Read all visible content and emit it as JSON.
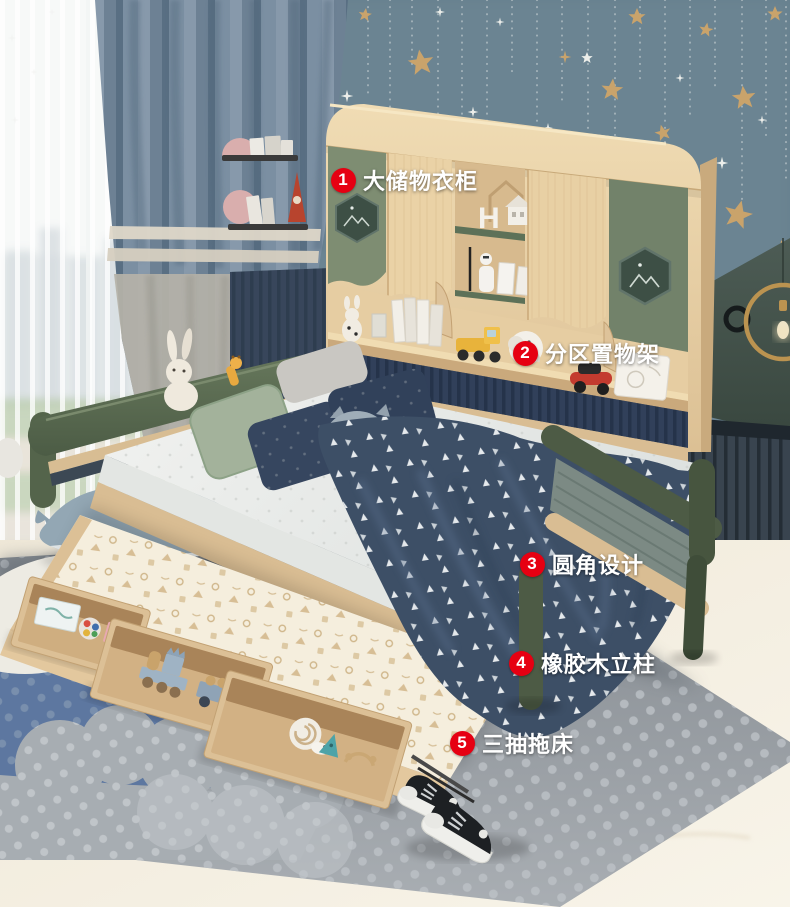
{
  "callouts": [
    {
      "number": "1",
      "label": "大储物衣柜"
    },
    {
      "number": "2",
      "label": "分区置物架"
    },
    {
      "number": "3",
      "label": "圆角设计"
    },
    {
      "number": "4",
      "label": "橡胶木立柱"
    },
    {
      "number": "5",
      "label": "三抽拖床"
    }
  ],
  "decor": {
    "letter_block": "H"
  },
  "colors": {
    "callout_red": "#e60012",
    "callout_text": "#ffffff",
    "wall_teal": "#66808e",
    "wall_dark_green": "#44524c",
    "wood_light": "#e8d2a9",
    "green_sage": "#7b8b6e",
    "green_dark": "#4a5844",
    "navy_blanket": "#3d4f66",
    "rug_gray": "#9aa0a5",
    "rug_blue": "#5d77a0",
    "star_gold": "#c9a36b"
  }
}
